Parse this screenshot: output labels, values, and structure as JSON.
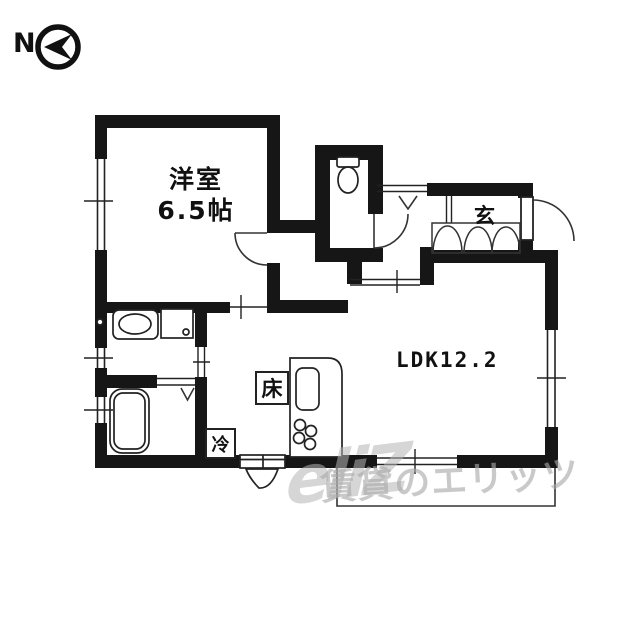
{
  "compass": {
    "label": "N"
  },
  "rooms": {
    "western": {
      "name": "洋室",
      "size": "6.5帖"
    },
    "ldk": {
      "name": "LDK12.2"
    },
    "entrance": {
      "name": "玄"
    }
  },
  "fixtures": {
    "floor_storage": "床",
    "refrigerator": "冷"
  },
  "watermark": {
    "logo": "eliZ",
    "text": "賃貸のエリッツ"
  },
  "colors": {
    "wall": "#161616",
    "line": "#222222",
    "watermark_gray": "#b0b0b0",
    "background": "#ffffff"
  }
}
